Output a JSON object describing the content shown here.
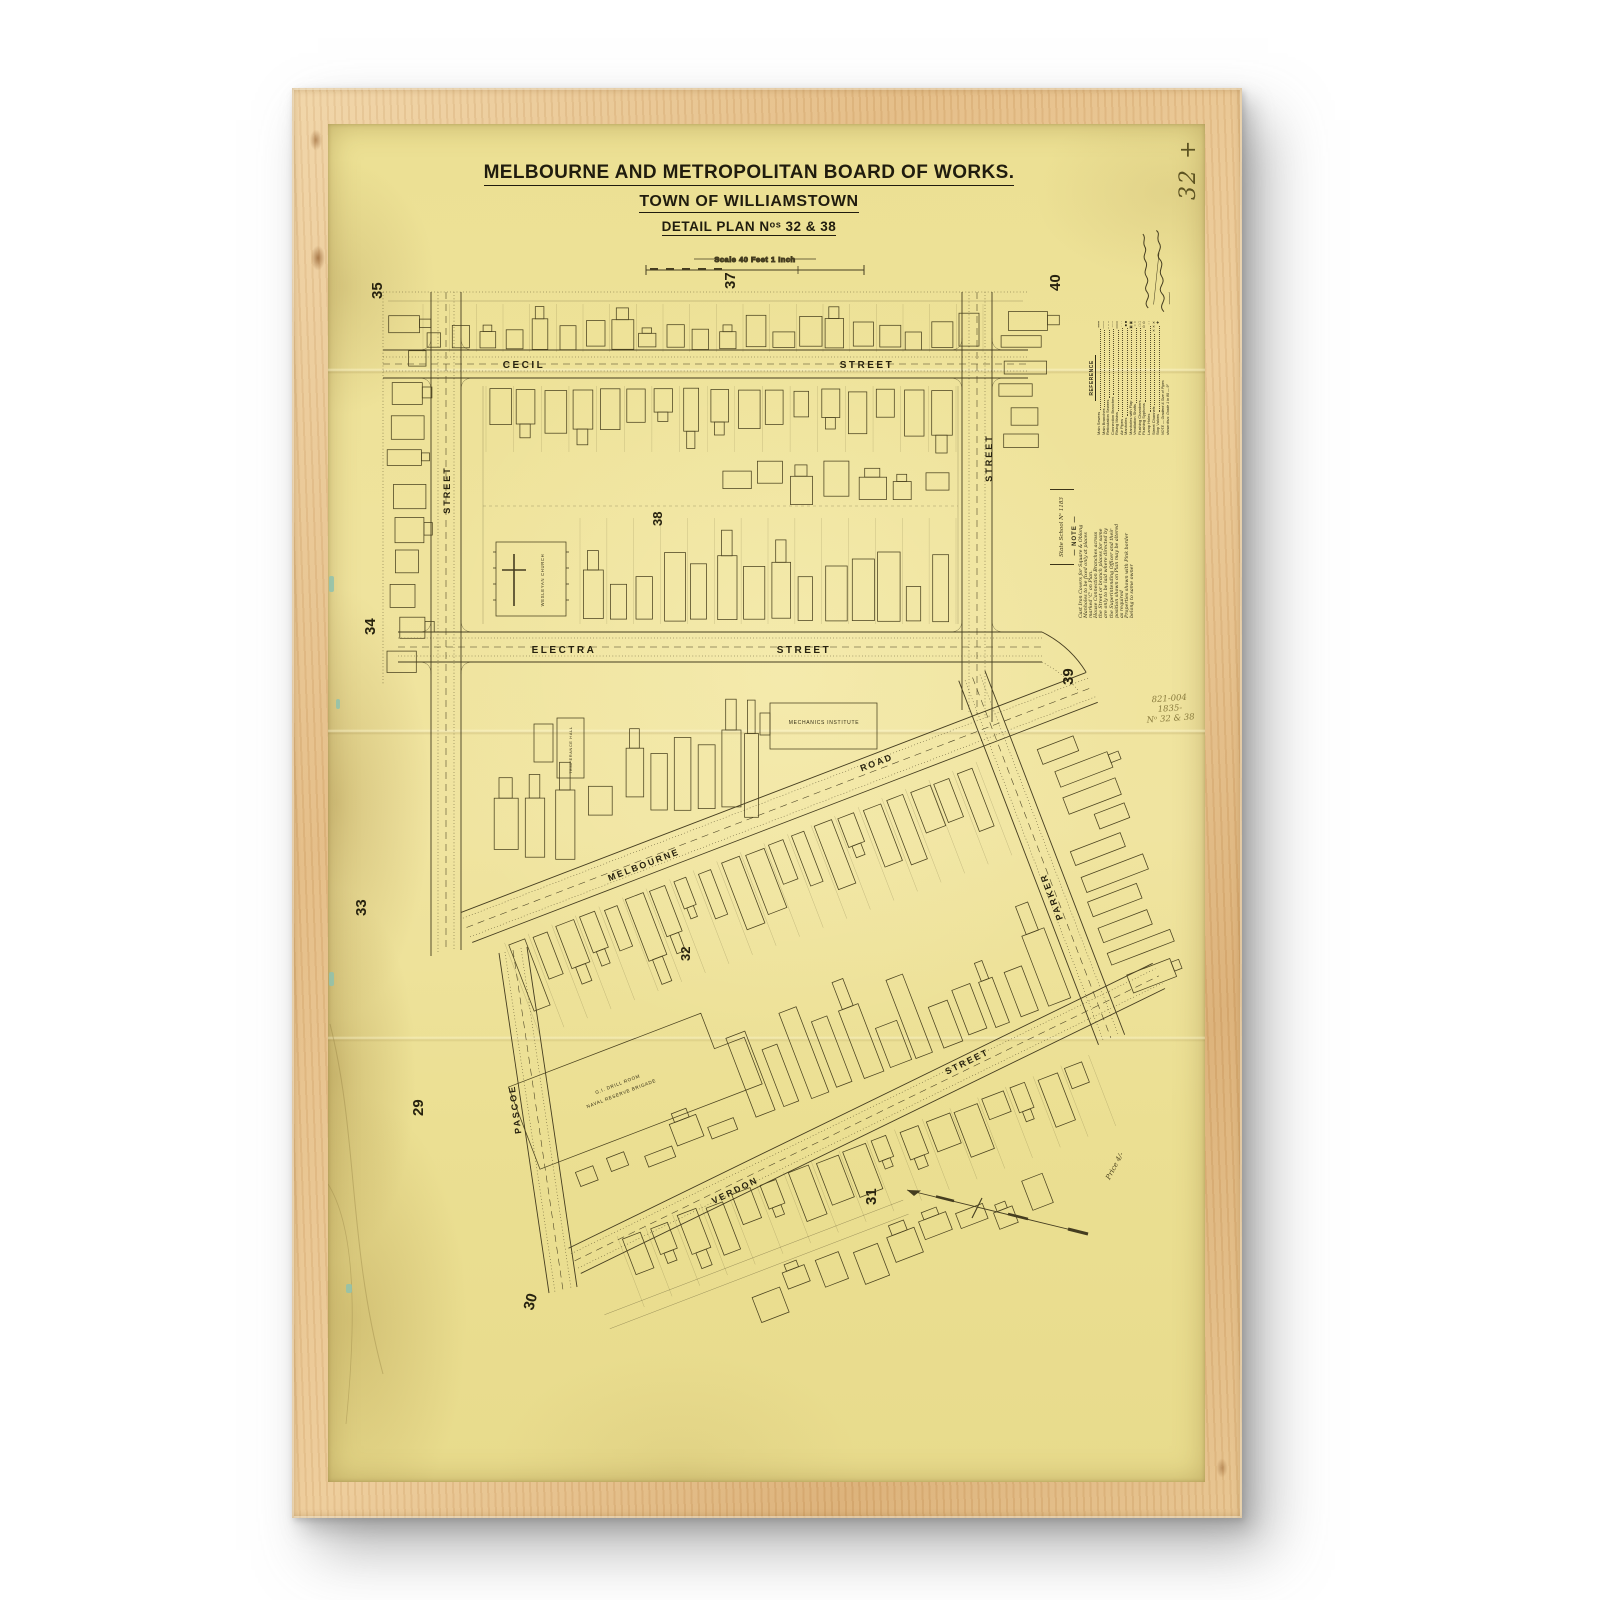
{
  "title_block": {
    "line1": "MELBOURNE AND METROPOLITAN BOARD OF WORKS.",
    "line2": "TOWN OF WILLIAMSTOWN",
    "line3": "DETAIL PLAN Nᵒˢ 32 & 38",
    "scale_label": "Scale 40 Feet   1 Inch"
  },
  "handwritten": {
    "corner_number": "32 +",
    "ref_lines": [
      "821-004",
      "1835-",
      "Nᵒ 32 & 38"
    ],
    "price": "Price 4/-"
  },
  "plan_numbers": {
    "n35": "35",
    "n37": "37",
    "n40": "40",
    "n34": "34",
    "n39": "39",
    "n33": "33",
    "n29": "29",
    "n30": "30",
    "n31": "31"
  },
  "block_numbers": {
    "b38": "38",
    "b32": "32"
  },
  "streets": {
    "cecil": "CECIL",
    "cecil_s": "STREET",
    "electra": "ELECTRA",
    "electra_s": "STREET",
    "left_street": "STREET",
    "right_street": "STREET",
    "melbourne": "MELBOURNE",
    "melbourne_road": "ROAD",
    "verdon": "VERDON",
    "verdon_s": "STREET",
    "pascoe": "PASCOE",
    "parker": "PARKER"
  },
  "buildings": {
    "wesleyan_church": "WESLEYAN CHURCH",
    "mechanics_institute": "MECHANICS INSTITUTE",
    "temperance_hall": "TEMPERANCE HALL",
    "drill_line1": "G.I. DRILL ROOM",
    "drill_line2": "NAVAL RESERVE BRIGADE",
    "state_school": "State School Nᵒ 1183"
  },
  "legend": {
    "title": "REFERENCE",
    "entries": [
      {
        "label": "Main Sewers",
        "symbol": "━━━"
      },
      {
        "label": "Main Branches",
        "symbol": "───"
      },
      {
        "label": "Reticulation Sewers",
        "symbol": "– – –"
      },
      {
        "label": "Connection Branches",
        "symbol": "┈┈┈"
      },
      {
        "label": "Rising Mains",
        "symbol": "═══"
      },
      {
        "label": "Air Pipes",
        "symbol": "· · ·"
      },
      {
        "label": "Manholes",
        "symbol": "■ ■"
      },
      {
        "label": "Manholes with Flap",
        "symbol": "▣ ▣"
      },
      {
        "label": "Ventilation Shafts",
        "symbol": "○ ○"
      },
      {
        "label": "Flushing Chambers",
        "symbol": "□ □"
      },
      {
        "label": "Flushing Syphons",
        "symbol": "⊙ ⊙"
      },
      {
        "label": "Lamp Holes",
        "symbol": "◦ ◦"
      },
      {
        "label": "Street Channels",
        "symbol": "✕ ✕ ✕"
      },
      {
        "label": "Stop Valves",
        "symbol": "✚"
      }
    ],
    "footer": [
      "NOTE — Gradient & Size of Pipes",
      "shown thus: Grade 1 in 80 — 9″"
    ]
  },
  "note": {
    "title": "— NOTE —",
    "lines": [
      "Cast Iron Covers for Square & Oblong",
      "Manholes to be fixed only at places",
      "marked 'C' on Plan.",
      "House Connection Branches across",
      "the Street or branch places for same",
      "are only to be laid where directed by",
      "the Superintending Officer and their",
      "position shown on Plan may be altered",
      "as required",
      "Properties shown with Pink border",
      "belong to same owner"
    ]
  },
  "colors": {
    "paper": "#efe39c",
    "ink": "#453d20",
    "frame_wood": "#e2b981",
    "pencil": "#8a7c3e"
  }
}
